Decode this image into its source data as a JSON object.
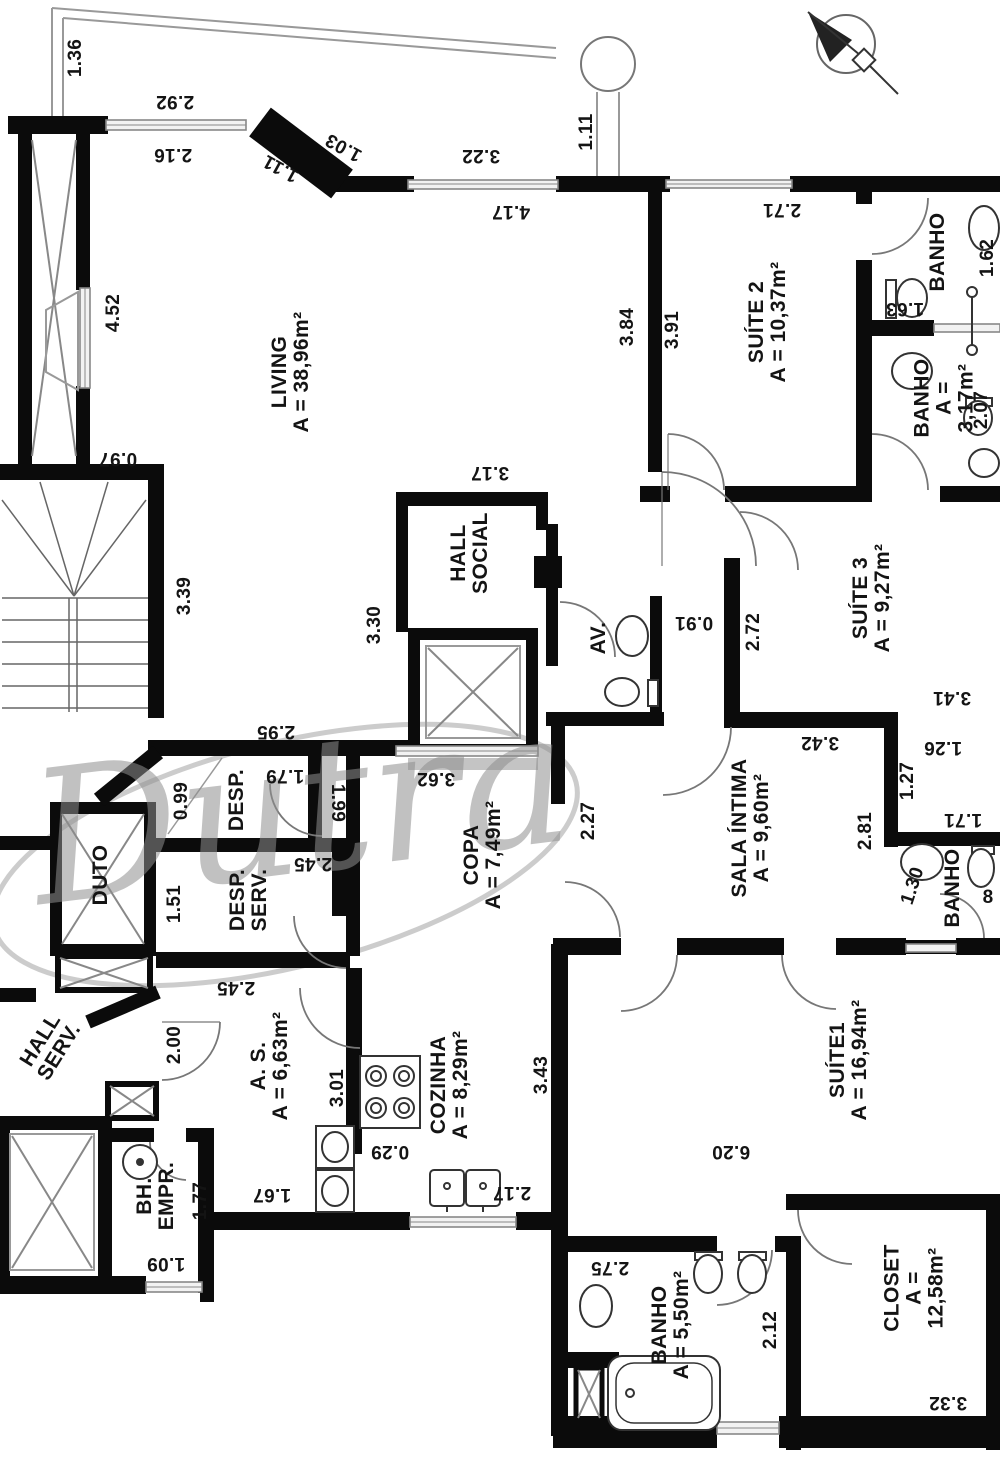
{
  "watermark": "Dutra",
  "north_arrow": "north-compass",
  "rooms": [
    {
      "id": "living",
      "name": "LIVING",
      "area": "A = 38,96m²",
      "x": 291,
      "y": 372,
      "rot": -90
    },
    {
      "id": "suite2",
      "name": "SUÍTE 2",
      "area": "A = 10,37m²",
      "x": 768,
      "y": 322,
      "rot": -90
    },
    {
      "id": "banho-suite2",
      "name": "BANHO",
      "area": "",
      "x": 938,
      "y": 252,
      "rot": -90
    },
    {
      "id": "banho-317",
      "name": "BANHO",
      "area": "A = 3,17m²",
      "x": 944,
      "y": 398,
      "rot": -90
    },
    {
      "id": "suite3",
      "name": "SUÍTE 3",
      "area": "A = 9,27m²",
      "x": 872,
      "y": 598,
      "rot": -90
    },
    {
      "id": "hall-social",
      "name": "HALL\nSOCIAL",
      "area": "",
      "x": 470,
      "y": 553,
      "rot": -90
    },
    {
      "id": "av",
      "name": "AV.",
      "area": "",
      "x": 599,
      "y": 638,
      "rot": -90
    },
    {
      "id": "sala-intima",
      "name": "SALA ÍNTIMA",
      "area": "A = 9,60m²",
      "x": 751,
      "y": 828,
      "rot": -90
    },
    {
      "id": "banho-sala",
      "name": "BANHO",
      "area": "",
      "x": 953,
      "y": 888,
      "rot": -90
    },
    {
      "id": "copa",
      "name": "COPA",
      "area": "A = 7,49m²",
      "x": 483,
      "y": 855,
      "rot": -90
    },
    {
      "id": "desp",
      "name": "DESP.",
      "area": "",
      "x": 237,
      "y": 800,
      "rot": -90
    },
    {
      "id": "desp-serv",
      "name": "DESP.\nSERV.",
      "area": "",
      "x": 249,
      "y": 900,
      "rot": -90
    },
    {
      "id": "duto",
      "name": "DUTO",
      "area": "",
      "x": 101,
      "y": 875,
      "rot": -90
    },
    {
      "id": "hall-serv",
      "name": "HALL\nSERV.",
      "area": "",
      "x": 50,
      "y": 1046,
      "rot": -58
    },
    {
      "id": "as",
      "name": "A. S.",
      "area": "A = 6,63m²",
      "x": 270,
      "y": 1066,
      "rot": -90
    },
    {
      "id": "cozinha",
      "name": "COZINHA",
      "area": "A = 8,29m²",
      "x": 450,
      "y": 1085,
      "rot": -90
    },
    {
      "id": "bh-empr",
      "name": "BH.\nEMPR.",
      "area": "",
      "x": 156,
      "y": 1196,
      "rot": -90
    },
    {
      "id": "suite1",
      "name": "SUÍTE1",
      "area": "A = 16,94m²",
      "x": 849,
      "y": 1060,
      "rot": -90
    },
    {
      "id": "banho-suite1",
      "name": "BANHO",
      "area": "A = 5,50m²",
      "x": 671,
      "y": 1325,
      "rot": -90
    },
    {
      "id": "closet",
      "name": "CLOSET",
      "area": "A = 12,58m²",
      "x": 914,
      "y": 1288,
      "rot": -90
    }
  ],
  "dimensions": [
    {
      "text": "1.36",
      "x": 76,
      "y": 58,
      "rot": -90
    },
    {
      "text": "2.92",
      "x": 175,
      "y": 101,
      "rot": 180
    },
    {
      "text": "2.16",
      "x": 173,
      "y": 154,
      "rot": 180
    },
    {
      "text": "1.03",
      "x": 344,
      "y": 147,
      "rot": 209
    },
    {
      "text": "1.11",
      "x": 281,
      "y": 168,
      "rot": 209
    },
    {
      "text": "3.22",
      "x": 481,
      "y": 155,
      "rot": 180
    },
    {
      "text": "4.17",
      "x": 511,
      "y": 211,
      "rot": 180
    },
    {
      "text": "1.11",
      "x": 587,
      "y": 132,
      "rot": -90
    },
    {
      "text": "3.84",
      "x": 628,
      "y": 327,
      "rot": -90
    },
    {
      "text": "3.91",
      "x": 673,
      "y": 330,
      "rot": -90
    },
    {
      "text": "2.71",
      "x": 782,
      "y": 209,
      "rot": 180
    },
    {
      "text": "1.62",
      "x": 988,
      "y": 258,
      "rot": -90
    },
    {
      "text": "1.63",
      "x": 905,
      "y": 308,
      "rot": 180
    },
    {
      "text": "2.07",
      "x": 982,
      "y": 410,
      "rot": -90
    },
    {
      "text": "4.52",
      "x": 114,
      "y": 313,
      "rot": -90
    },
    {
      "text": "0.97",
      "x": 118,
      "y": 458,
      "rot": 180
    },
    {
      "text": "3.39",
      "x": 185,
      "y": 596,
      "rot": -90
    },
    {
      "text": "3.17",
      "x": 490,
      "y": 472,
      "rot": 180
    },
    {
      "text": "3.30",
      "x": 375,
      "y": 625,
      "rot": -90
    },
    {
      "text": "0.91",
      "x": 694,
      "y": 622,
      "rot": 180
    },
    {
      "text": "2.72",
      "x": 754,
      "y": 632,
      "rot": -90
    },
    {
      "text": "3.41",
      "x": 952,
      "y": 697,
      "rot": 180
    },
    {
      "text": "2.95",
      "x": 276,
      "y": 731,
      "rot": 180
    },
    {
      "text": "1.79",
      "x": 285,
      "y": 775,
      "rot": 180
    },
    {
      "text": "0.99",
      "x": 182,
      "y": 801,
      "rot": -90
    },
    {
      "text": "1.99",
      "x": 337,
      "y": 803,
      "rot": 90
    },
    {
      "text": "1.51",
      "x": 175,
      "y": 904,
      "rot": -90
    },
    {
      "text": "2.45",
      "x": 313,
      "y": 863,
      "rot": 180
    },
    {
      "text": "2.45",
      "x": 236,
      "y": 987,
      "rot": 180
    },
    {
      "text": "3.62",
      "x": 436,
      "y": 778,
      "rot": 180
    },
    {
      "text": "2.27",
      "x": 589,
      "y": 821,
      "rot": -90
    },
    {
      "text": "3.42",
      "x": 820,
      "y": 742,
      "rot": 180
    },
    {
      "text": "1.26",
      "x": 943,
      "y": 747,
      "rot": 180
    },
    {
      "text": "1.27",
      "x": 908,
      "y": 781,
      "rot": -90
    },
    {
      "text": "1.71",
      "x": 963,
      "y": 819,
      "rot": 180
    },
    {
      "text": "2.81",
      "x": 866,
      "y": 831,
      "rot": -90
    },
    {
      "text": "1.30",
      "x": 913,
      "y": 886,
      "rot": -72
    },
    {
      "text": "8",
      "x": 988,
      "y": 898,
      "rot": 0
    },
    {
      "text": "2.00",
      "x": 175,
      "y": 1045,
      "rot": -90
    },
    {
      "text": "3.01",
      "x": 338,
      "y": 1088,
      "rot": -90
    },
    {
      "text": "1.67",
      "x": 272,
      "y": 1194,
      "rot": 180
    },
    {
      "text": "1.77",
      "x": 201,
      "y": 1201,
      "rot": -90
    },
    {
      "text": "1.09",
      "x": 166,
      "y": 1263,
      "rot": 180
    },
    {
      "text": "0.29",
      "x": 390,
      "y": 1151,
      "rot": 180
    },
    {
      "text": "3.43",
      "x": 542,
      "y": 1075,
      "rot": -90
    },
    {
      "text": "2.17",
      "x": 512,
      "y": 1192,
      "rot": 180
    },
    {
      "text": "6.20",
      "x": 731,
      "y": 1151,
      "rot": 180
    },
    {
      "text": "2.75",
      "x": 610,
      "y": 1267,
      "rot": 180
    },
    {
      "text": "2.12",
      "x": 771,
      "y": 1330,
      "rot": -90
    },
    {
      "text": "3.32",
      "x": 948,
      "y": 1402,
      "rot": 180
    }
  ]
}
